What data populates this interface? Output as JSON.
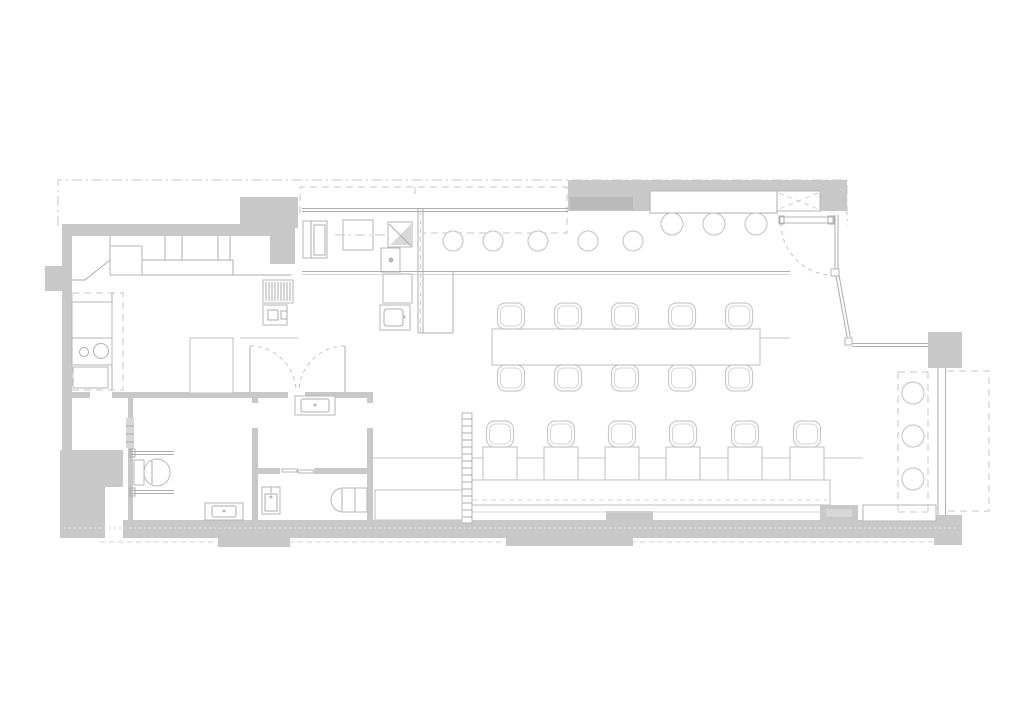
{
  "plan": {
    "title": "Restaurant floor plan — monochrome architectural line drawing (top view)",
    "type": "architectural-floor-plan",
    "drawing_style": "thin light-grey lines on white, grey poché walls, dashed site/ceiling outlines",
    "rooms": [
      {
        "name": "kitchen",
        "fixtures": [
          "L-shaped worktop with divisions",
          "wall counter with double-bowl sink",
          "extractor hood (dashed outline)",
          "island / cold unit",
          "grill with hatched top",
          "under-counter unit",
          "pass equipment stack",
          "prep sink"
        ]
      },
      {
        "name": "bar",
        "fixtures": [
          "long bar counter",
          "recessed niche with hatch panel",
          "bar stools"
        ]
      },
      {
        "name": "dining-room",
        "fixtures": [
          "communal table with ten chairs",
          "six two-top tables",
          "six chairs",
          "wall banquette bench",
          "radiator strip",
          "low cabinet"
        ]
      },
      {
        "name": "window-bar",
        "fixtures": [
          "dashed window counter",
          "three stools",
          "shopfront glazing"
        ]
      },
      {
        "name": "accessible-wc",
        "fixtures": [
          "toilet with cistern",
          "two grab bars",
          "washbasin"
        ]
      },
      {
        "name": "wc-lobby",
        "fixtures": [
          "vanity washbasin"
        ]
      },
      {
        "name": "wc",
        "fixtures": [
          "small washbasin",
          "toilet",
          "sliding door"
        ]
      },
      {
        "name": "store-room",
        "fixtures": []
      }
    ],
    "counts": {
      "bar_stools": 8,
      "window_stools": 3,
      "communal_table_chairs": 10,
      "two_top_tables": 6,
      "two_top_chairs": 6,
      "banquette_benches": 1,
      "toilets": 2,
      "washbasins": 4,
      "sink_bowls_kitchen": 2,
      "entrance_doors": 1,
      "double_swing_doors": 1,
      "sliding_doors": 1,
      "radiators": 1
    },
    "colors": {
      "wall": "#c8c8c8",
      "wall_dark": "#b9b9b9",
      "wall_light": "#d7d7d7",
      "line": "#aeaeae",
      "fixture": "#b6b6b6",
      "furn": "#c9c9c9",
      "dash": "#c6c6c6",
      "dash_light": "#dedede",
      "bg": "#ffffff"
    }
  }
}
